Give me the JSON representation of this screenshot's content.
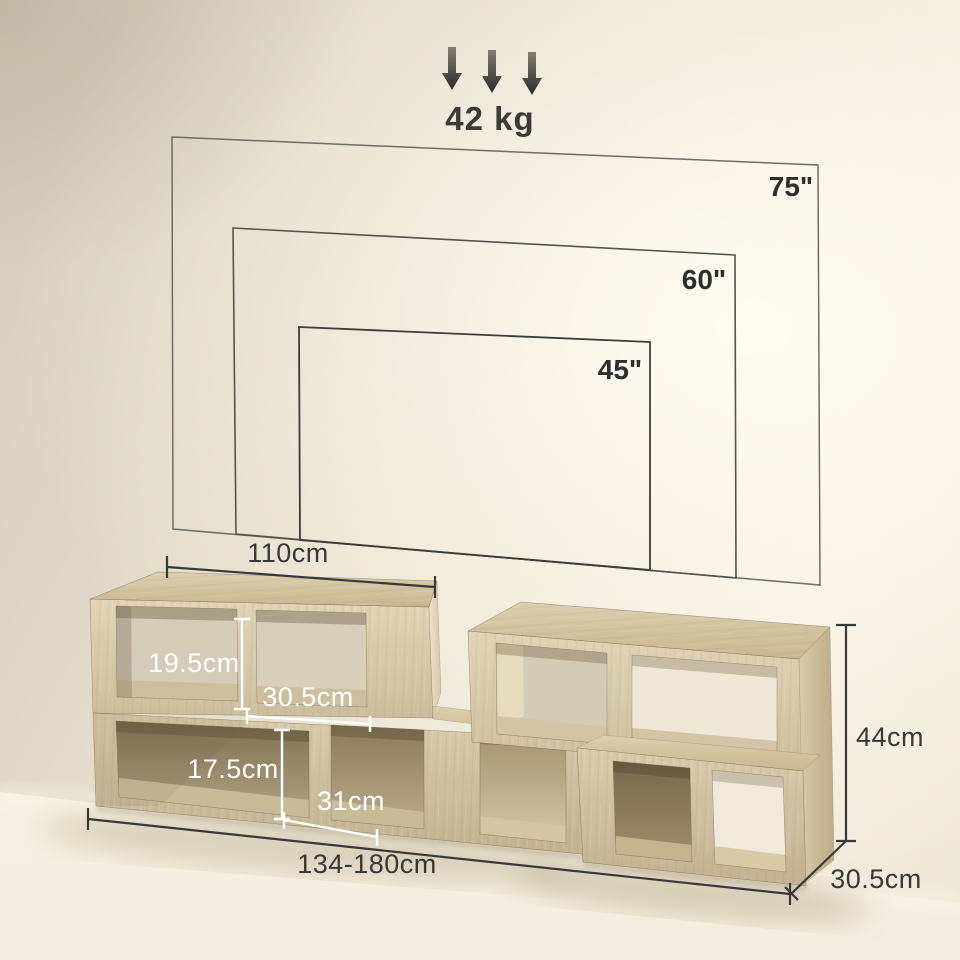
{
  "capacity": {
    "label": "42 kg"
  },
  "icons": {
    "load_direction": "down-arrow"
  },
  "tv_outlines": [
    {
      "size": "75\""
    },
    {
      "size": "60\""
    },
    {
      "size": "45\""
    }
  ],
  "dimensions": {
    "top_width": "110cm",
    "upper_compartment_height": "19.5cm",
    "upper_compartment_width": "30.5cm",
    "lower_compartment_height": "17.5cm",
    "lower_compartment_width": "31cm",
    "total_width": "134-180cm",
    "total_height": "44cm",
    "depth": "30.5cm"
  },
  "colors": {
    "annotation_dark": "#383838",
    "annotation_light": "#ffffff",
    "wood": "#d6c6a5",
    "wall": "#e9e2d2"
  }
}
